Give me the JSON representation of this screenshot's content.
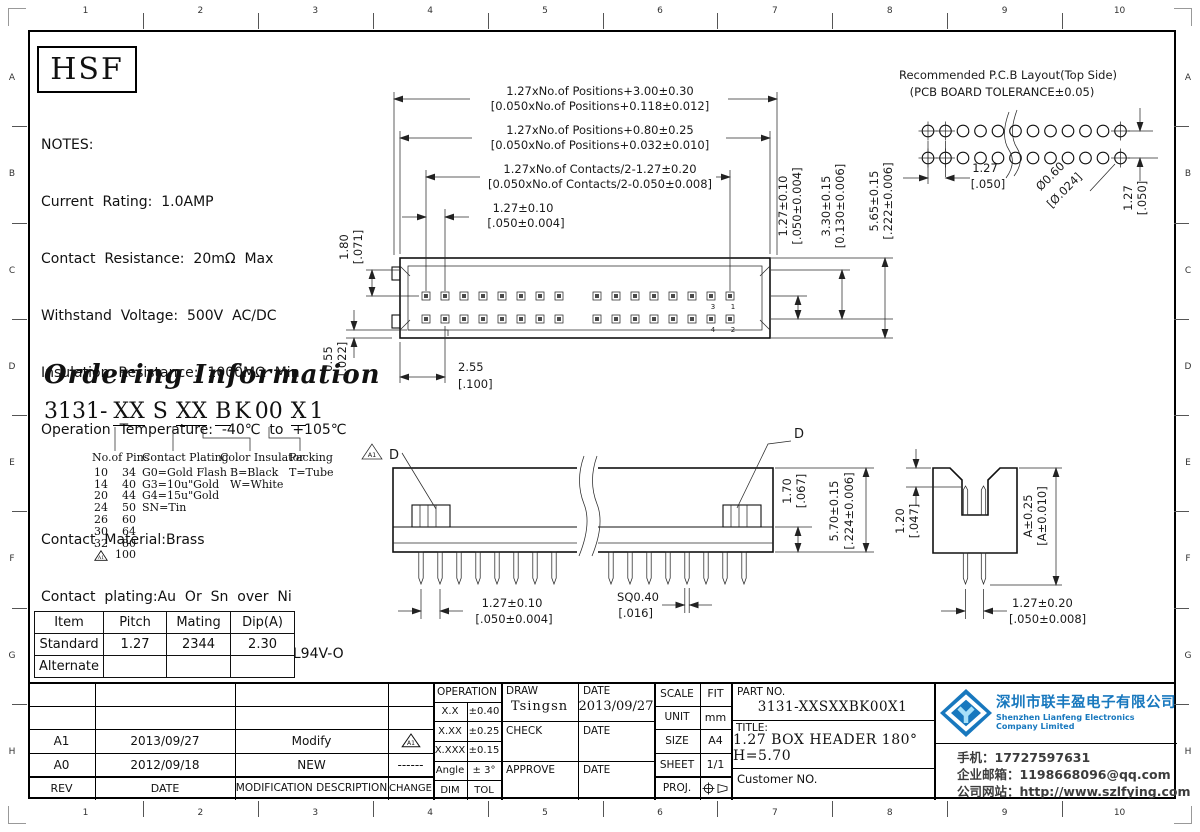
{
  "frame": {
    "cols": [
      "1",
      "2",
      "3",
      "4",
      "5",
      "6",
      "7",
      "8",
      "9",
      "10"
    ],
    "rows": [
      "A",
      "B",
      "C",
      "D",
      "E",
      "F",
      "G",
      "H"
    ]
  },
  "logo": {
    "text": "HSF"
  },
  "notes": {
    "title": "NOTES:",
    "lines": [
      "Current  Rating:  1.0AMP",
      "Contact  Resistance:  20mΩ  Max",
      "Withstand  Voltage:  500V  AC/DC",
      "Insulation  Resistance:  1000MΩ  Min",
      "Operation  Temperature:  -40℃  to  +105℃"
    ],
    "materials": [
      "Contact  Material:Brass",
      "Contact  plating:Au  Or  Sn  over  Ni",
      "Insulator  Material:PA9T+30%G.F  UL94V-O"
    ]
  },
  "ordering": {
    "title": "Ordering Information",
    "code_parts": [
      "3131-",
      "XX",
      "S",
      "XX",
      "B",
      "K",
      "00",
      "X",
      "1"
    ],
    "columns": {
      "pins": {
        "label": "No.of Pins",
        "rows": [
          [
            "10",
            "34"
          ],
          [
            "14",
            "40"
          ],
          [
            "20",
            "44"
          ],
          [
            "24",
            "50"
          ],
          [
            "26",
            "60"
          ],
          [
            "30",
            "64"
          ],
          [
            "32",
            "80"
          ]
        ],
        "last": {
          "mark": "A1",
          "value": "100"
        }
      },
      "plating": {
        "label": "Contact Plating",
        "items": [
          "G0=Gold Flash",
          "G3=10u\"Gold",
          "G4=15u\"Gold",
          "SN=Tin"
        ]
      },
      "color": {
        "label": "Color Insulator",
        "items": [
          "B=Black",
          "W=White"
        ]
      },
      "packing": {
        "label": "Packing",
        "items": [
          "T=Tube"
        ]
      }
    }
  },
  "spec_table": {
    "headers": [
      "Item",
      "Pitch",
      "Mating",
      "Dip(A)"
    ],
    "rows": [
      [
        "Standard",
        "1.27",
        "2344",
        "2.30"
      ],
      [
        "Alternate",
        "",
        "",
        ""
      ]
    ]
  },
  "pcb": {
    "title": "Recommended  P.C.B  Layout(Top  Side)",
    "subtitle": "(PCB  BOARD  TOLERANCE±0.05)",
    "dim_pitch_h": [
      "1.27",
      "[.050]"
    ],
    "dim_hole": [
      "Ø0.60",
      "[Ø.024]"
    ],
    "dim_pitch_v": [
      "1.27",
      "[.050]"
    ]
  },
  "top_view": {
    "dim_row1": [
      "1.27xNo.of  Positions+3.00±0.30",
      "[0.050xNo.of  Positions+0.118±0.012]"
    ],
    "dim_row2": [
      "1.27xNo.of  Positions+0.80±0.25",
      "[0.050xNo.of  Positions+0.032±0.010]"
    ],
    "dim_row3": [
      "1.27xNo.of  Contacts/2-1.27±0.20",
      "[0.050xNo.of  Contacts/2-0.050±0.008]"
    ],
    "dim_pitch": [
      "1.27±0.10",
      "[.050±0.004]"
    ],
    "dim_180": [
      "1.80",
      "[.071]"
    ],
    "dim_055": [
      "0.55",
      "[.022]"
    ],
    "dim_255": [
      "2.55",
      "[.100]"
    ],
    "dim_rowsp": [
      "1.27±0.10",
      "[.050±0.004]"
    ],
    "dim_330": [
      "3.30±0.15",
      "[0.130±0.006]"
    ],
    "dim_565": [
      "5.65±0.15",
      "[.222±0.006]"
    ],
    "pin_numbers": [
      "3",
      "1",
      "4",
      "2"
    ]
  },
  "side_view": {
    "d_label": "D",
    "a1_mark": "A1",
    "dim_pitch": [
      "1.27±0.10",
      "[.050±0.004]"
    ],
    "dim_sq": [
      "SQ0.40",
      "[.016]"
    ],
    "dim_170": [
      "1.70",
      "[.067]"
    ],
    "dim_570": [
      "5.70±0.15",
      "[.224±0.006]"
    ]
  },
  "end_view": {
    "dim_120": [
      "1.20",
      "[.047]"
    ],
    "dim_a": [
      "A±0.25",
      "[A±0.010]"
    ],
    "dim_pitch": [
      "1.27±0.20",
      "[.050±0.008]"
    ]
  },
  "rev_table": {
    "headers": {
      "rev": "REV",
      "date": "DATE",
      "desc": "MODIFICATION  DESCRIPTION",
      "change": "CHANGE"
    },
    "rows": [
      {
        "rev": "A1",
        "date": "2013/09/27",
        "desc": "Modify",
        "change": "A1"
      },
      {
        "rev": "A0",
        "date": "2012/09/18",
        "desc": "NEW",
        "change": "------"
      }
    ]
  },
  "title_block": {
    "operation": {
      "header": "OPERATION",
      "rows": [
        [
          "X.X",
          "±0.40"
        ],
        [
          "X.XX",
          "±0.25"
        ],
        [
          "X.XXX",
          "±0.15"
        ],
        [
          "Angle",
          "± 3°"
        ],
        [
          "DIM",
          "TOL"
        ]
      ]
    },
    "sign": {
      "draw_label": "DRAW",
      "draw_value": "Tsingsn",
      "draw_date_label": "DATE",
      "draw_date_value": "2013/09/27",
      "check_label": "CHECK",
      "check_date_label": "DATE",
      "approve_label": "APPROVE",
      "approve_date_label": "DATE"
    },
    "info": {
      "rows": [
        [
          "SCALE",
          "FIT"
        ],
        [
          "UNIT",
          "mm"
        ],
        [
          "SIZE",
          "A4"
        ],
        [
          "SHEET",
          "1/1"
        ]
      ],
      "proj_label": "PROJ."
    },
    "part": {
      "part_no_label": "PART  NO.",
      "part_no": "3131-XXSXXBK00X1",
      "title_label": "TITLE:",
      "title": "1.27 BOX HEADER 180° H=5.70",
      "customer_label": "Customer  NO."
    }
  },
  "company": {
    "name_cn": "深圳市联丰盈电子有限公司",
    "name_en": "Shenzhen Lianfeng Electronics Company Limited",
    "phone": "手机：17727597631",
    "email": "企业邮箱：1198668096@qq.com",
    "website": "公司网站：http://www.szlfying.com",
    "brand_color": "#1878be"
  }
}
